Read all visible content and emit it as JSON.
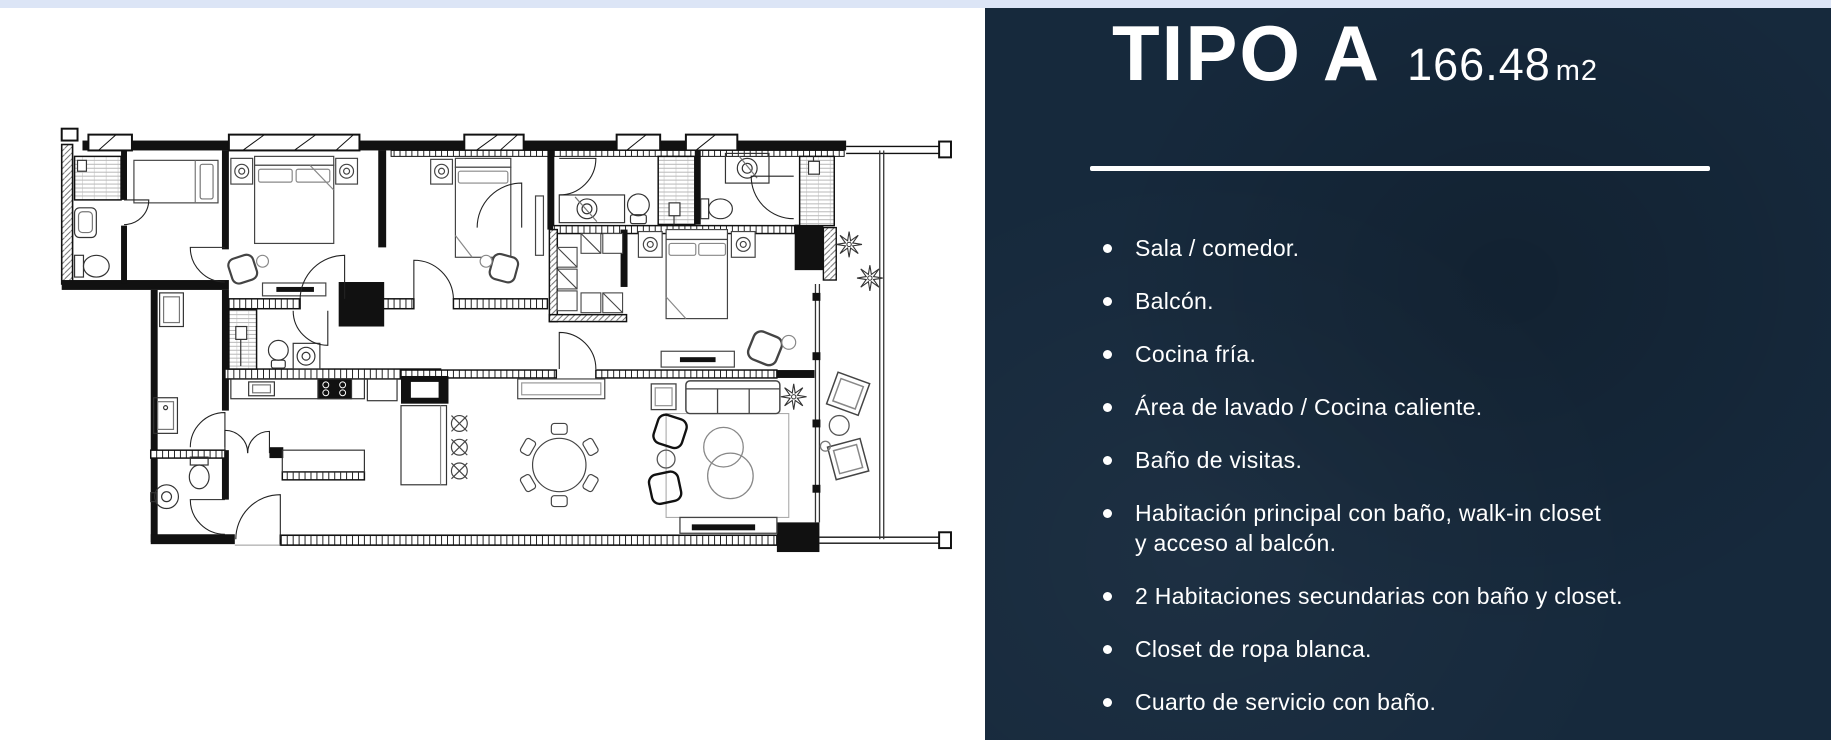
{
  "page": {
    "colors": {
      "top_strip": "#dce5f6",
      "panel_bg": "#16293c",
      "text": "#ffffff",
      "plan_bg": "#ffffff",
      "plan_lines": "#111111"
    }
  },
  "panel": {
    "title": "TIPO A",
    "area_value": "166.48",
    "area_unit": "m2",
    "features": [
      "Sala / comedor.",
      "Balcón.",
      "Cocina fría.",
      "Área de lavado / Cocina caliente.",
      "Baño de visitas.",
      "Habitación principal con baño, walk-in closet y acceso al balcón.",
      "2 Habitaciones secundarias con baño y closet.",
      "Closet de ropa blanca.",
      "Cuarto de servicio con baño."
    ]
  },
  "floor_plan": {
    "label": "Planta arquitectónica Tipo A",
    "fixtures": [
      "shower",
      "sink",
      "toilet",
      "bed",
      "nightstand",
      "walk-in-closet",
      "dining-table",
      "sofa",
      "armchair",
      "rug",
      "tv-console",
      "kitchen-counter",
      "stove",
      "island",
      "barstool",
      "washer",
      "plant",
      "lounge-chair",
      "balcony"
    ]
  }
}
